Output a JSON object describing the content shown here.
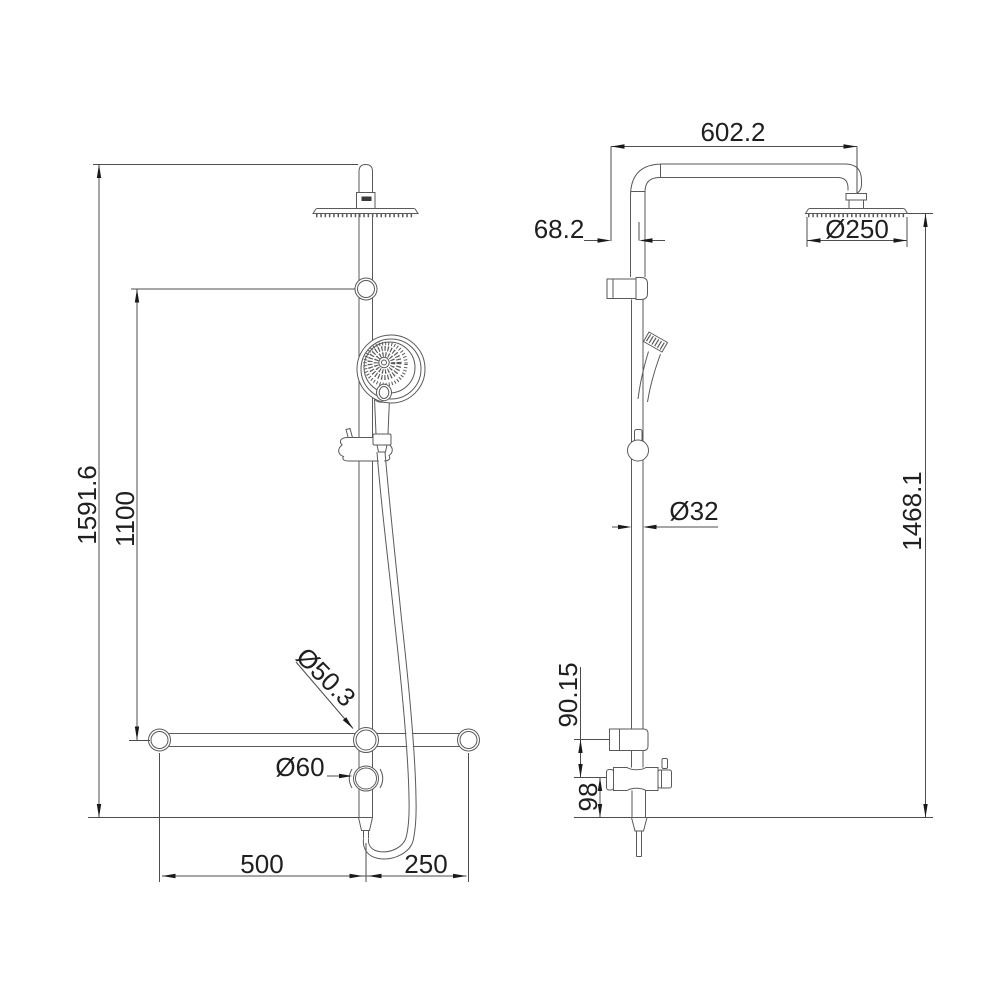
{
  "drawing": {
    "kind": "shower-column-technical-drawing",
    "background": "#ffffff",
    "line_color": "#5a5a5a",
    "text_color": "#1f1f1f",
    "views": {
      "front": {
        "name": "front elevation view"
      },
      "side": {
        "name": "side elevation view"
      }
    },
    "dimensions": {
      "front": {
        "overall_height": "1591.6",
        "rail_height": "1100",
        "rail_joint_diameter": "Ø50.3",
        "diverter_knob_diameter": "Ø60",
        "bar_left_length": "500",
        "bar_right_length": "250"
      },
      "side": {
        "arm_reach": "602.2",
        "wall_to_column": "68.2",
        "head_diameter": "Ø250",
        "column_diameter": "Ø32",
        "column_height": "1468.1",
        "bracket_to_diverter": "90.15",
        "diverter_to_outlet": "98"
      }
    }
  }
}
